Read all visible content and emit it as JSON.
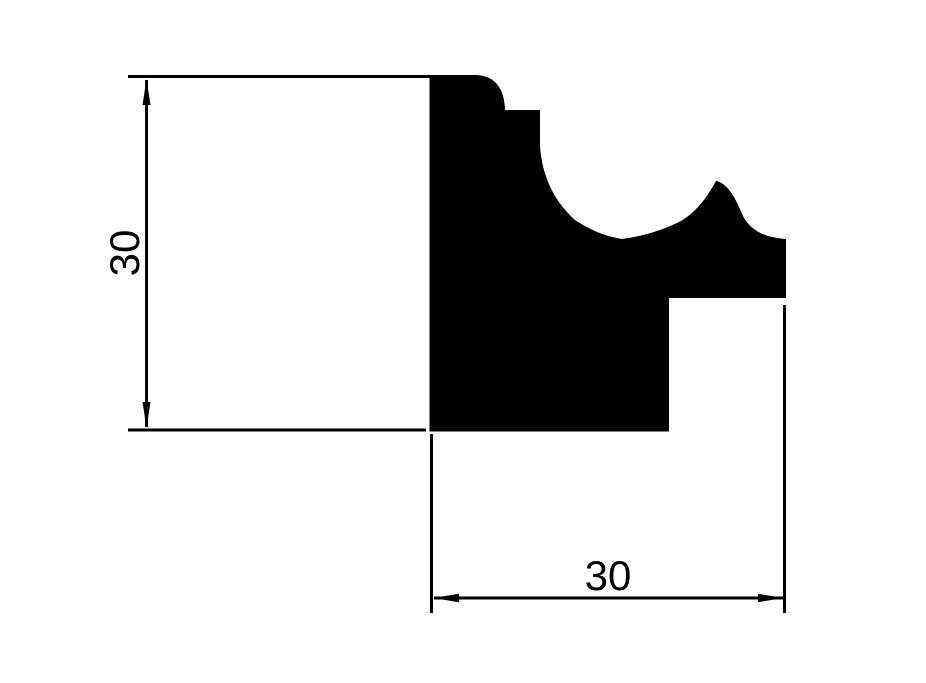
{
  "drawing": {
    "background_color": "#ffffff",
    "ink_color": "#000000",
    "profile_description": "Solid black cross-section silhouette of a decorative moulding: stepped rounded top-left corner, large concave cove curve, pointed ogee peak, right rebate step and rectangular base",
    "dimensions": {
      "vertical": {
        "label": "30",
        "orientation": "vertical",
        "side": "left"
      },
      "horizontal": {
        "label": "30",
        "orientation": "horizontal",
        "side": "bottom"
      }
    }
  }
}
